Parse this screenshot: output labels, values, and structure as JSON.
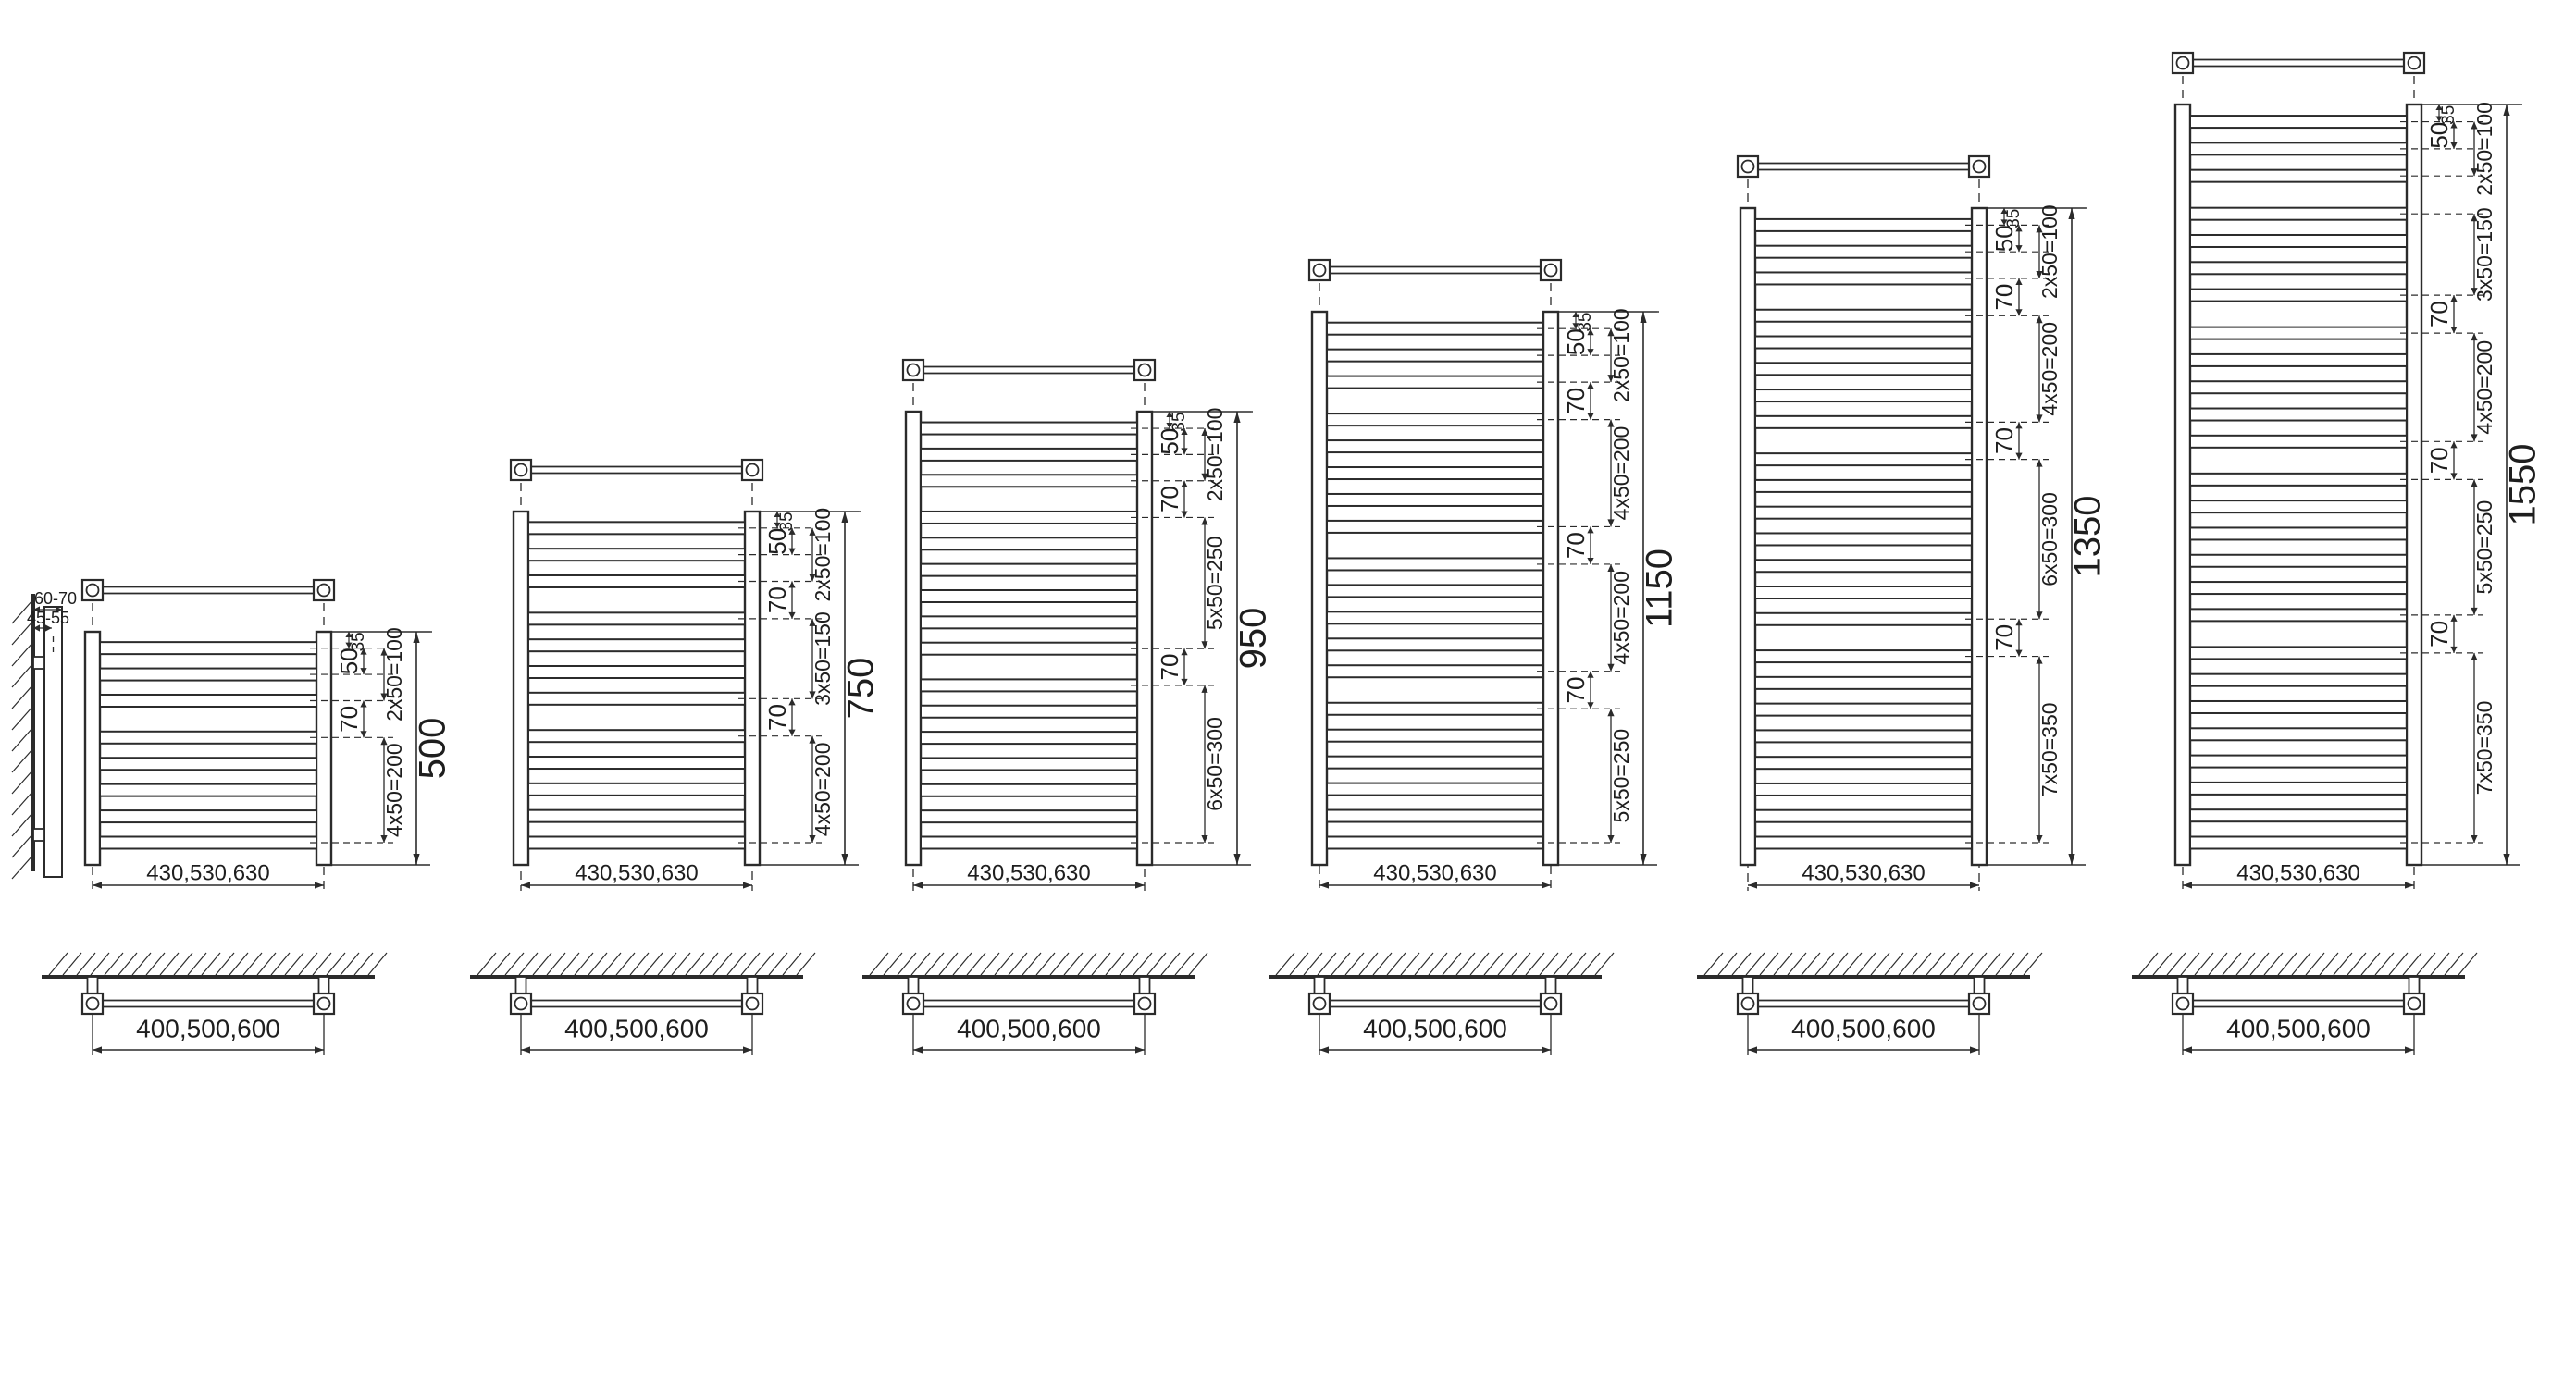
{
  "drawing": {
    "type": "towel-radiator-dimension-diagrams",
    "line_color": "#2b2b2b",
    "background": "#ffffff"
  },
  "side_view": {
    "total_depth_label": "60-70",
    "bracket_depth_label": "45-55"
  },
  "models": [
    {
      "height_label": "500",
      "top_offset_label": "35",
      "pitch_label": "50",
      "width_label": "430,530,630",
      "mount_width_label": "400,500,600",
      "sections": [
        {
          "type": "group",
          "tubes": 3,
          "label": "2x50=100",
          "mm": 100
        },
        {
          "type": "gap",
          "label": "70",
          "mm": 70
        },
        {
          "type": "group",
          "tubes": 5,
          "label": "4x50=200",
          "mm": 200
        }
      ]
    },
    {
      "height_label": "750",
      "top_offset_label": "35",
      "pitch_label": "50",
      "width_label": "430,530,630",
      "mount_width_label": "400,500,600",
      "sections": [
        {
          "type": "group",
          "tubes": 3,
          "label": "2x50=100",
          "mm": 100
        },
        {
          "type": "gap",
          "label": "70",
          "mm": 70
        },
        {
          "type": "group",
          "tubes": 4,
          "label": "3x50=150",
          "mm": 150
        },
        {
          "type": "gap",
          "label": "70",
          "mm": 70
        },
        {
          "type": "group",
          "tubes": 5,
          "label": "4x50=200",
          "mm": 200
        }
      ]
    },
    {
      "height_label": "950",
      "top_offset_label": "35",
      "pitch_label": "50",
      "width_label": "430,530,630",
      "mount_width_label": "400,500,600",
      "sections": [
        {
          "type": "group",
          "tubes": 3,
          "label": "2x50=100",
          "mm": 100
        },
        {
          "type": "gap",
          "label": "70",
          "mm": 70
        },
        {
          "type": "group",
          "tubes": 6,
          "label": "5x50=250",
          "mm": 250
        },
        {
          "type": "gap",
          "label": "70",
          "mm": 70
        },
        {
          "type": "group",
          "tubes": 7,
          "label": "6x50=300",
          "mm": 300
        }
      ]
    },
    {
      "height_label": "1150",
      "top_offset_label": "35",
      "pitch_label": "50",
      "width_label": "430,530,630",
      "mount_width_label": "400,500,600",
      "sections": [
        {
          "type": "group",
          "tubes": 3,
          "label": "2x50=100",
          "mm": 100
        },
        {
          "type": "gap",
          "label": "70",
          "mm": 70
        },
        {
          "type": "group",
          "tubes": 5,
          "label": "4x50=200",
          "mm": 200
        },
        {
          "type": "gap",
          "label": "70",
          "mm": 70
        },
        {
          "type": "group",
          "tubes": 5,
          "label": "4x50=200",
          "mm": 200
        },
        {
          "type": "gap",
          "label": "70",
          "mm": 70
        },
        {
          "type": "group",
          "tubes": 6,
          "label": "5x50=250",
          "mm": 250
        }
      ]
    },
    {
      "height_label": "1350",
      "top_offset_label": "35",
      "pitch_label": "50",
      "width_label": "430,530,630",
      "mount_width_label": "400,500,600",
      "sections": [
        {
          "type": "group",
          "tubes": 3,
          "label": "2x50=100",
          "mm": 100
        },
        {
          "type": "gap",
          "label": "70",
          "mm": 70
        },
        {
          "type": "group",
          "tubes": 5,
          "label": "4x50=200",
          "mm": 200
        },
        {
          "type": "gap",
          "label": "70",
          "mm": 70
        },
        {
          "type": "group",
          "tubes": 7,
          "label": "6x50=300",
          "mm": 300
        },
        {
          "type": "gap",
          "label": "70",
          "mm": 70
        },
        {
          "type": "group",
          "tubes": 8,
          "label": "7x50=350",
          "mm": 350
        }
      ]
    },
    {
      "height_label": "1550",
      "top_offset_label": "35",
      "pitch_label": "50",
      "width_label": "430,530,630",
      "mount_width_label": "400,500,600",
      "sections": [
        {
          "type": "group",
          "tubes": 3,
          "label": "2x50=100",
          "mm": 100
        },
        {
          "type": "gap",
          "label": "",
          "mm": 70
        },
        {
          "type": "group",
          "tubes": 4,
          "label": "3x50=150",
          "mm": 150
        },
        {
          "type": "gap",
          "label": "70",
          "mm": 70
        },
        {
          "type": "group",
          "tubes": 5,
          "label": "4x50=200",
          "mm": 200
        },
        {
          "type": "gap",
          "label": "70",
          "mm": 70
        },
        {
          "type": "group",
          "tubes": 6,
          "label": "5x50=250",
          "mm": 250
        },
        {
          "type": "gap",
          "label": "70",
          "mm": 70
        },
        {
          "type": "group",
          "tubes": 8,
          "label": "7x50=350",
          "mm": 350
        }
      ]
    }
  ]
}
